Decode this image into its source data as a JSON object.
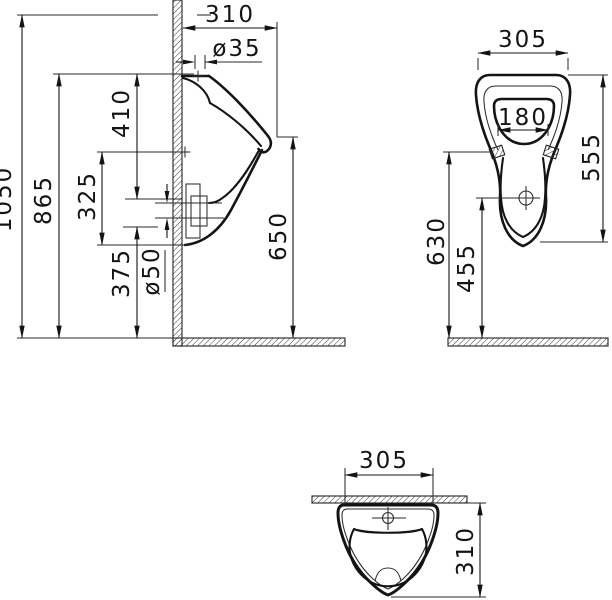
{
  "drawing": {
    "subject": "wall-hung-urinal-technical-drawing",
    "colors": {
      "line": "#141414",
      "background": "#ffffff"
    },
    "views": {
      "side": {
        "overall_height": "1050",
        "rim_height": "865",
        "inlet_to_outlet": "410",
        "bolt_to_bottom": "325",
        "bottom_to_floor": "375",
        "outlet_diameter": "ø50",
        "front_edge_height": "650",
        "depth": "310",
        "inlet_diameter": "ø35"
      },
      "front": {
        "width": "305",
        "opening_width": "180",
        "body_height": "555",
        "bolt_height": "630",
        "drain_height": "455"
      },
      "top": {
        "width": "305",
        "depth": "310"
      }
    }
  }
}
